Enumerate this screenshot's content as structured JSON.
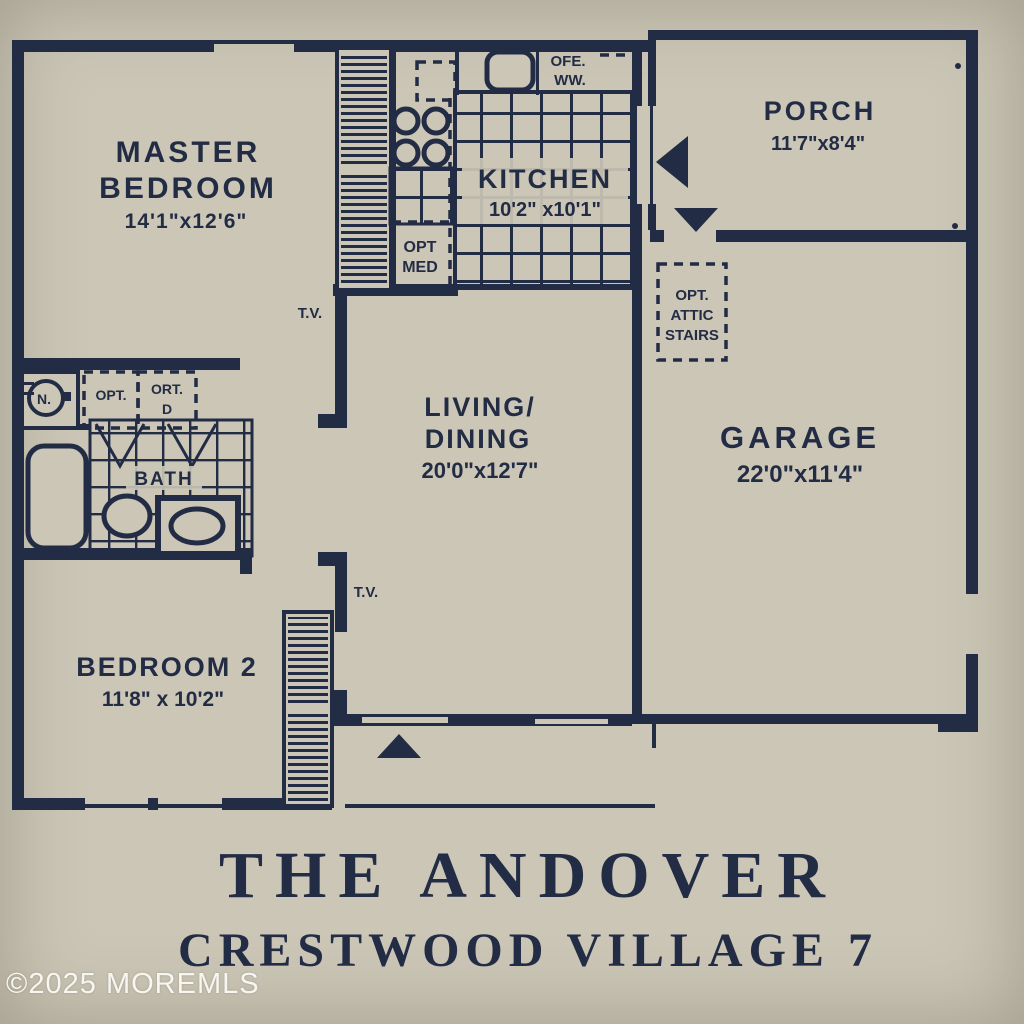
{
  "colors": {
    "paper": "#cbc6b6",
    "ink": "#232c45",
    "wm": "#f7f6f1"
  },
  "plan": {
    "master": {
      "line1": "MASTER",
      "line2": "BEDROOM",
      "dims": "14'1\"x12'6\""
    },
    "kitchen": {
      "line1": "KITCHEN",
      "dims": "10'2\" x10'1\""
    },
    "porch": {
      "line1": "PORCH",
      "dims": "11'7\"x8'4\""
    },
    "living": {
      "line1": "LIVING/",
      "line2": "DINING",
      "dims": "20'0\"x12'7\""
    },
    "garage": {
      "line1": "GARAGE",
      "dims": "22'0\"x11'4\""
    },
    "bedroom2": {
      "line1": "BEDROOM 2",
      "dims": "11'8\" x 10'2\""
    },
    "bath": {
      "label": "BATH"
    },
    "labels": {
      "tv1": "T.V.",
      "tv2": "T.V.",
      "opt_med_1": "OPT",
      "opt_med_2": "MED",
      "attic_1": "OPT.",
      "attic_2": "ATTIC",
      "attic_3": "STAIRS",
      "ofe_1": "OFE.",
      "ofe_2": "WW.",
      "opt_w": "OPT.",
      "opt_d_1": "ORT.",
      "opt_d_2": "D",
      "washer": "N."
    }
  },
  "title": {
    "line1": "THE ANDOVER",
    "line2": "CRESTWOOD VILLAGE 7"
  },
  "watermark": "©2025 MOREMLS"
}
